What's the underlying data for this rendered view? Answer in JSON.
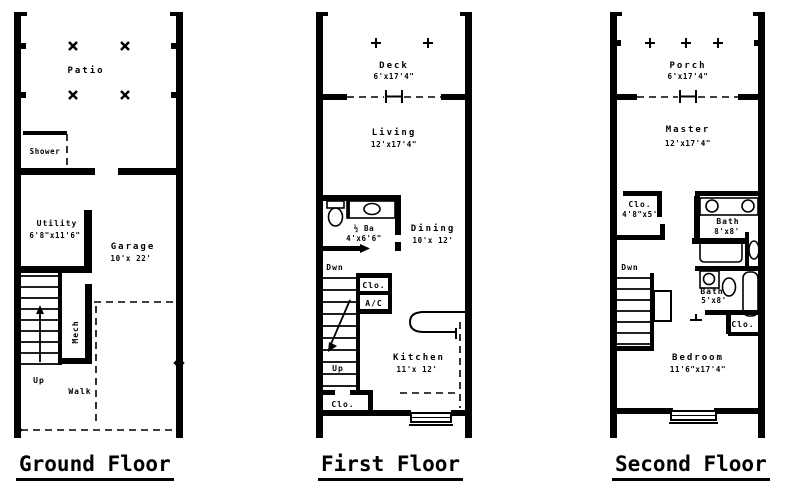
{
  "colors": {
    "ink": "#000000",
    "paper": "#ffffff"
  },
  "captions": {
    "ground": "Ground Floor",
    "first": "First Floor",
    "second": "Second Floor"
  },
  "ground": {
    "patio": "Patio",
    "shower": "Shower",
    "utility": "Utility",
    "utility_dim": "6'8\"x11'6\"",
    "garage": "Garage",
    "garage_dim": "10'x 22'",
    "mech": "Mech",
    "up": "Up",
    "walk": "Walk"
  },
  "first": {
    "deck": "Deck",
    "deck_dim": "6'x17'4\"",
    "living": "Living",
    "living_dim": "12'x17'4\"",
    "powder": "½ Ba",
    "powder_dim": "4'x6'6\"",
    "dining": "Dining",
    "dining_dim": "10'x 12'",
    "dwn": "Dwn",
    "clo": "Clo.",
    "ac": "A/C",
    "up": "Up",
    "kitchen": "Kitchen",
    "kitchen_dim": "11'x 12'",
    "clo2": "Clo."
  },
  "second": {
    "porch": "Porch",
    "porch_dim": "6'x17'4\"",
    "master": "Master",
    "master_dim": "12'x17'4\"",
    "clo": "Clo.",
    "clo_dim": "4'8\"x5'",
    "bath1": "Bath",
    "bath1_dim": "8'x8'",
    "dwn": "Dwn",
    "bath2": "Bath",
    "bath2_dim": "5'x8'",
    "clo2": "Clo.",
    "bedroom": "Bedroom",
    "bedroom_dim": "11'6\"x17'4\""
  }
}
